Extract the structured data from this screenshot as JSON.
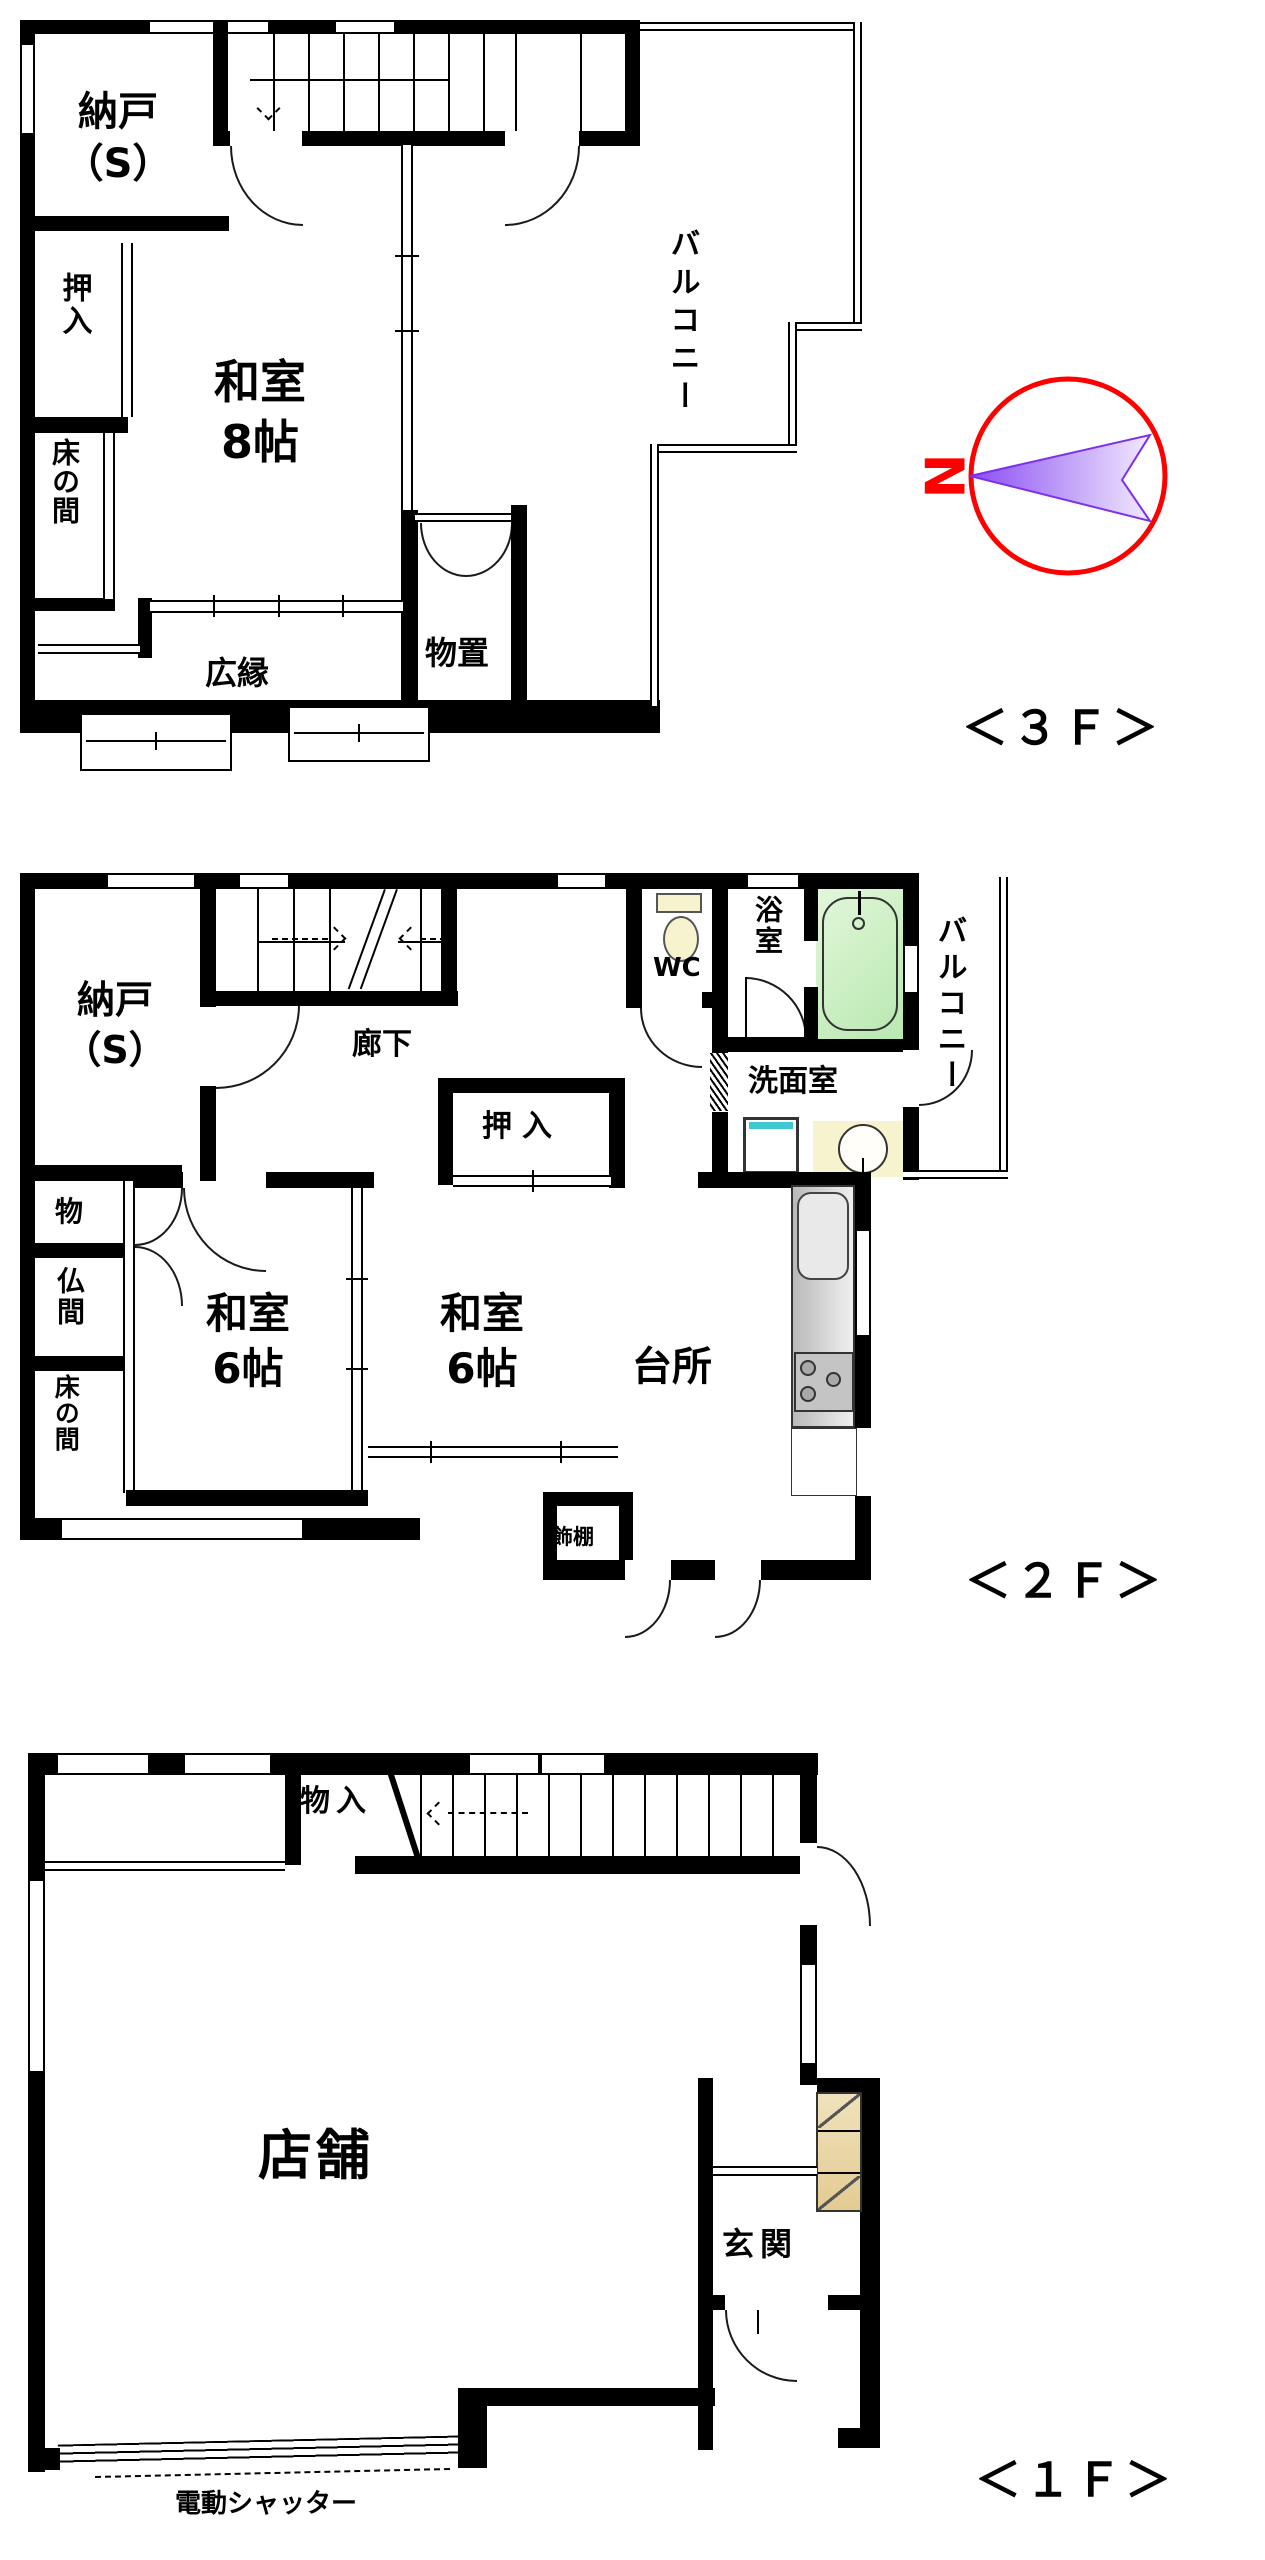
{
  "colors": {
    "wall": "#000000",
    "compass_red": "#ff0000",
    "arrow_purple": "#7b2ff0",
    "tub_green": "#b8e8b0",
    "fixture_yellow": "#f8f3cf",
    "cabinet_tan": "#e3cb93",
    "counter_gray": "#d9d9d9",
    "washer_teal": "#40c8d0"
  },
  "compass": {
    "north_label": "N"
  },
  "floor3": {
    "caption": "＜３Ｆ＞",
    "nando_line1": "納戸",
    "nando_line2": "（S）",
    "oshiire": "押入",
    "tokonoma": "床の間",
    "washitsu_line1": "和室",
    "washitsu_line2": "8帖",
    "balcony": "バルコニー",
    "monooki": "物置",
    "hiroen": "広縁"
  },
  "floor2": {
    "caption": "＜２Ｆ＞",
    "nando_line1": "納戸",
    "nando_line2": "（S）",
    "rouka": "廊下",
    "wc": "WC",
    "yokushitsu": "浴室",
    "balcony": "バルコニー",
    "senmenshitsu": "洗面室",
    "oshiire": "押入",
    "mono": "物",
    "butsuma": "仏間",
    "tokonoma": "床の間",
    "washitsu_a_line1": "和室",
    "washitsu_a_line2": "6帖",
    "washitsu_b_line1": "和室",
    "washitsu_b_line2": "6帖",
    "daidokoro": "台所",
    "kazaridana": "飾棚"
  },
  "floor1": {
    "caption": "＜１Ｆ＞",
    "monoiri": "物入",
    "tenpo": "店舗",
    "genkan": "玄関",
    "shutter": "電動シャッター"
  }
}
